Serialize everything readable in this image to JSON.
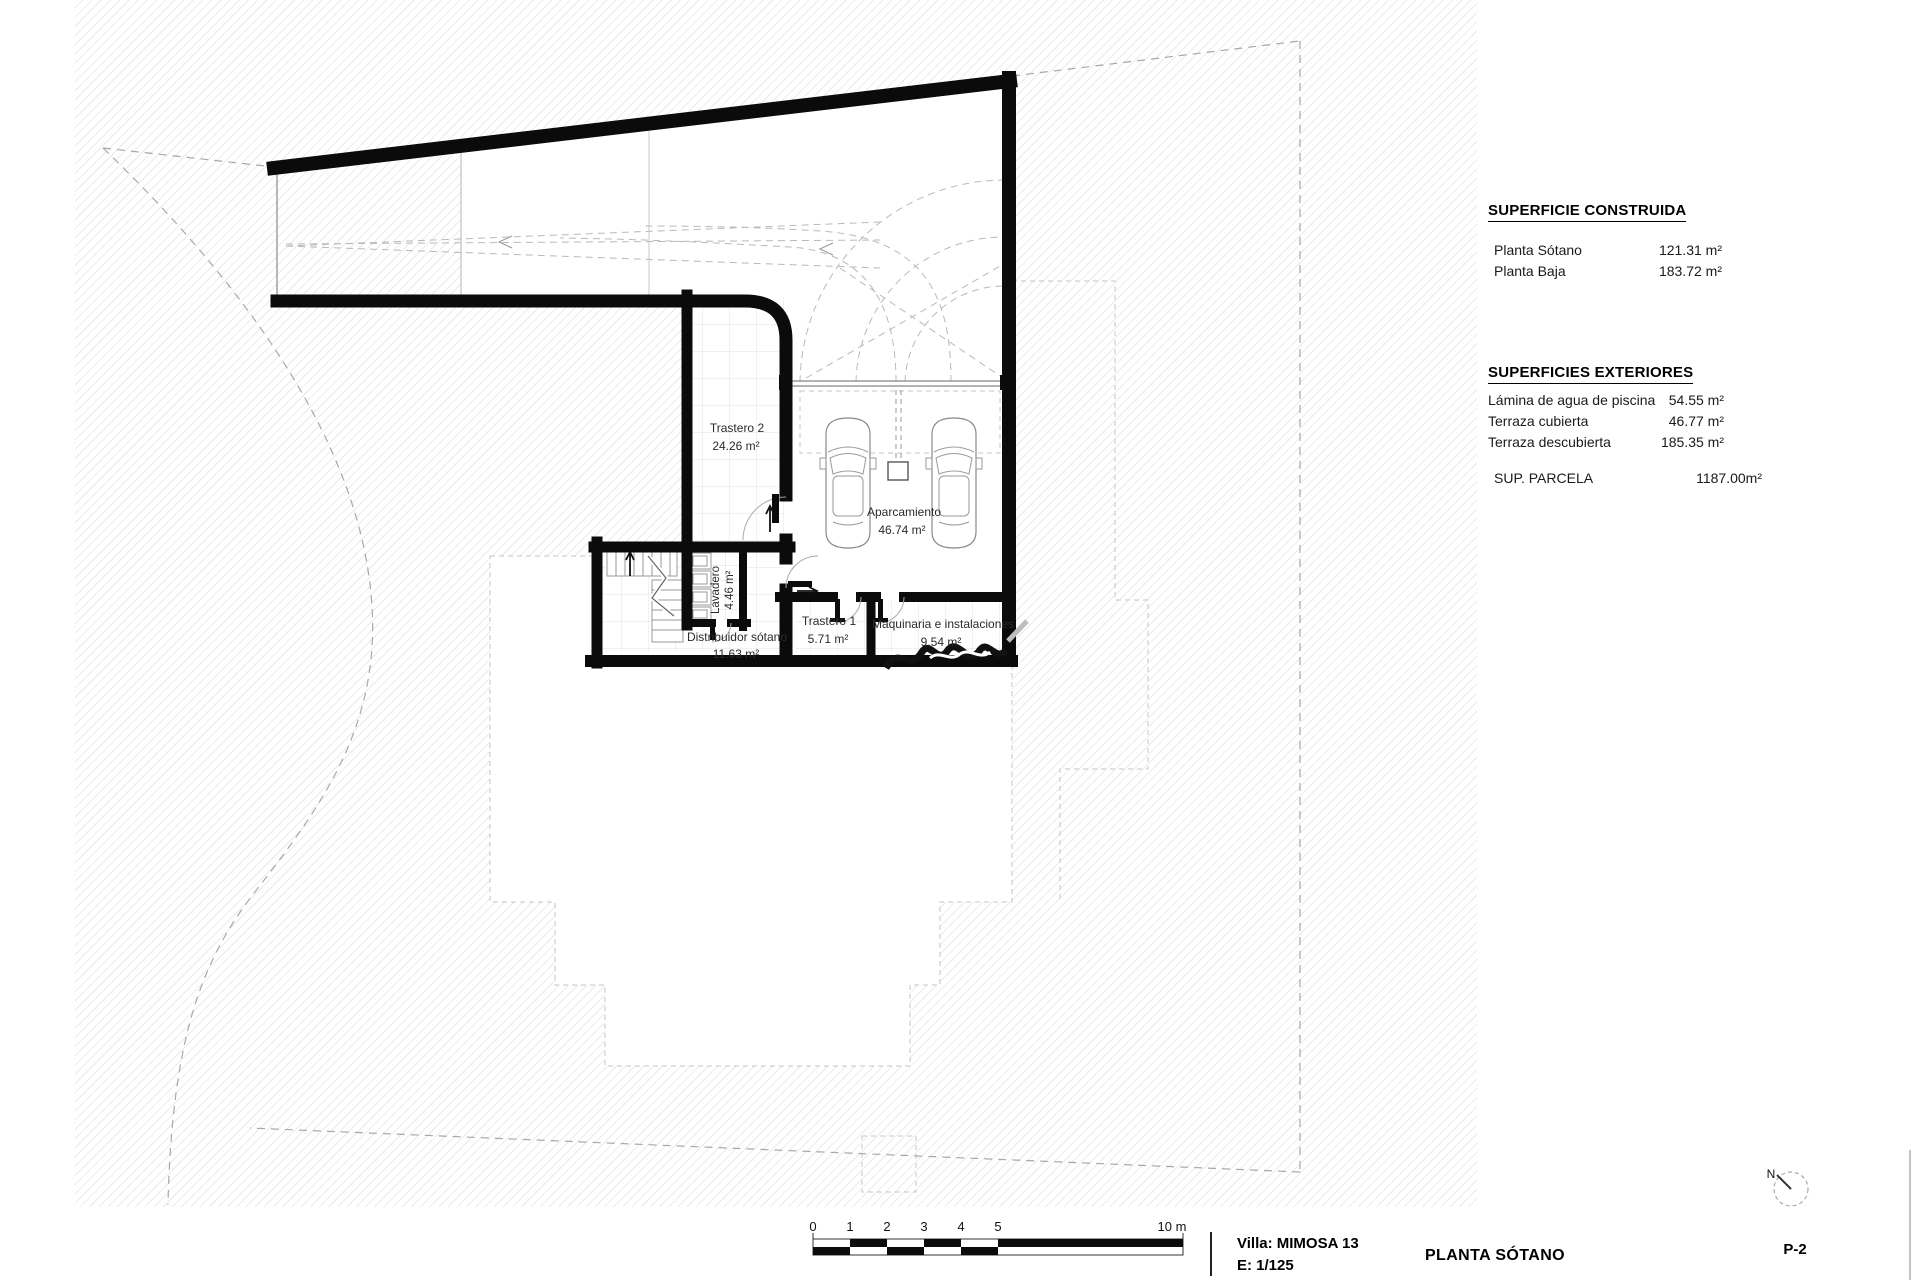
{
  "plan": {
    "north_label": "N",
    "rooms": [
      {
        "name": "Trastero 2",
        "area": "24.26 m²"
      },
      {
        "name": "Aparcamiento",
        "area": "46.74 m²"
      },
      {
        "name": "Trastero 1",
        "area": "5.71 m²"
      },
      {
        "name": "Maquinaria e instalaciones",
        "area": "9.54 m²"
      },
      {
        "name": "Distribuidor sótano",
        "area": "11.63 m²"
      },
      {
        "name": "Lavadero",
        "area": "4.46 m²"
      }
    ]
  },
  "tables": {
    "construida": {
      "title": "SUPERFICIE CONSTRUIDA",
      "rows": [
        {
          "label": "Planta Sótano",
          "value": "121.31 m²"
        },
        {
          "label": "Planta Baja",
          "value": "183.72 m²"
        }
      ]
    },
    "exteriores": {
      "title": "SUPERFICIES EXTERIORES",
      "rows": [
        {
          "label": "Lámina de agua de piscina",
          "value": "54.55 m²"
        },
        {
          "label": "Terraza cubierta",
          "value": "46.77 m²"
        },
        {
          "label": "Terraza descubierta",
          "value": "185.35 m²"
        }
      ]
    },
    "parcela": {
      "label": "SUP. PARCELA",
      "value": "1187.00m²"
    }
  },
  "titleblock": {
    "project": "Villa: MIMOSA 13",
    "scale": "E:  1/125",
    "sheet_title": "PLANTA SÓTANO",
    "sheet_number": "P-2"
  },
  "scalebar": {
    "ticks": [
      "0",
      "1",
      "2",
      "3",
      "4",
      "5"
    ],
    "end_label": "10 m"
  },
  "colors": {
    "wall": "#0b0b0b",
    "hatch_line": "#d6d6d6",
    "boundary_dash": "#a8a8a8",
    "projection_dash": "#c6c6c6"
  }
}
